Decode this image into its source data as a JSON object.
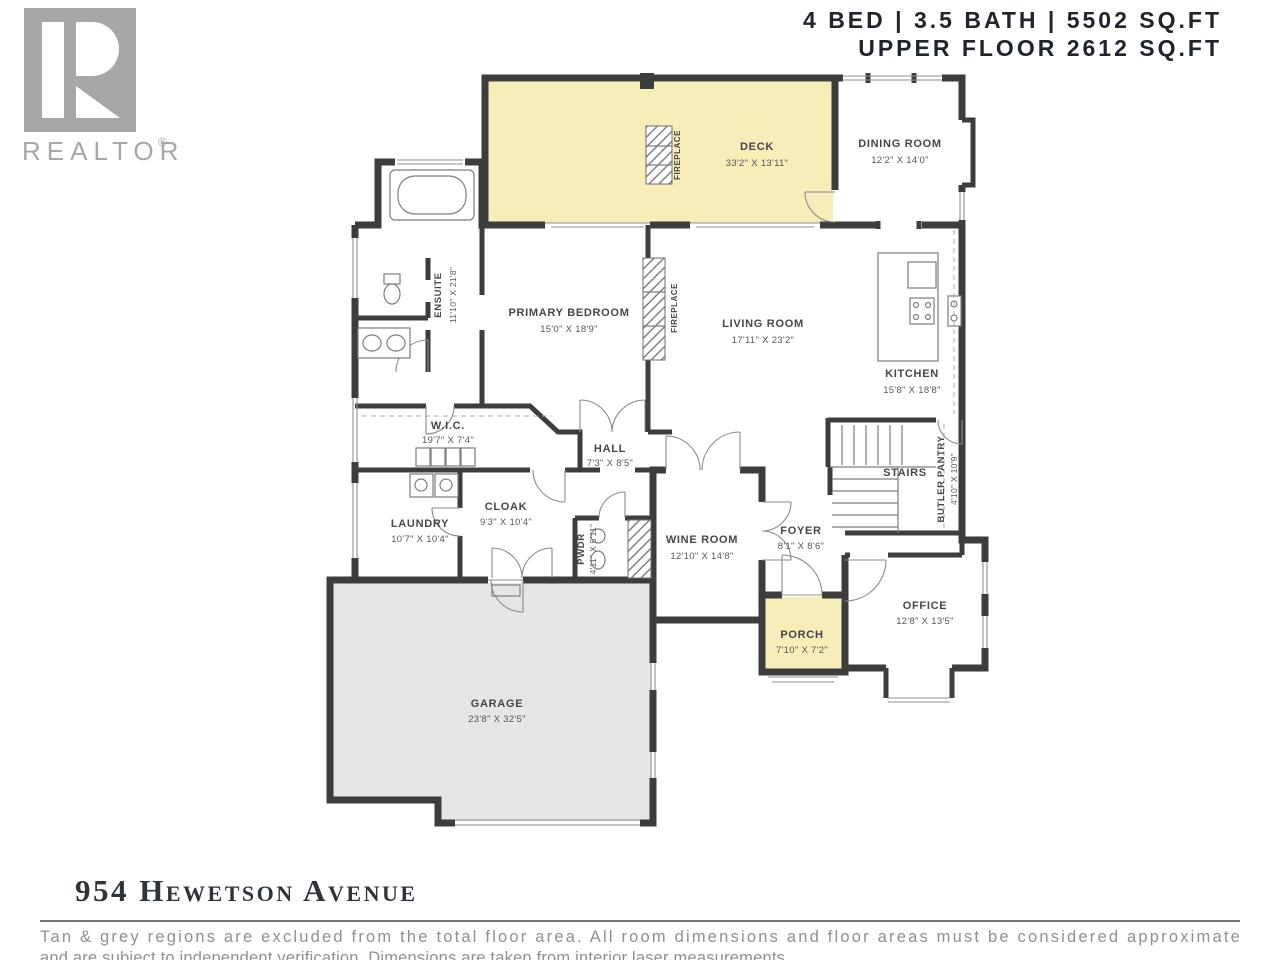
{
  "header": {
    "line1": "4 BED | 3.5 BATH | 5502 SQ.FT",
    "line2": "UPPER FLOOR 2612 SQ.FT"
  },
  "logo": {
    "brand": "REALTOR",
    "registered": "®"
  },
  "footer": {
    "title": "954 Hewetson Avenue",
    "disclaimer_line1": "Tan & grey regions are excluded from the total floor area. All room dimensions and floor areas must be considered approximate",
    "disclaimer_line2": "and are subject to independent verification. Dimensions are taken from interior laser measurements."
  },
  "colors": {
    "wall": "#3d3d3d",
    "excluded_tan": "#f6edb8",
    "excluded_grey": "#e4e5e6",
    "logo_grey": "#a7a7a7",
    "heading_text": "#20242c",
    "label_text": "#474747",
    "disclaimer_text": "#909090"
  },
  "rooms": {
    "deck": {
      "name": "DECK",
      "dims": "33'2\" X 13'11\""
    },
    "dining": {
      "name": "DINING ROOM",
      "dims": "12'2\" X 14'0\""
    },
    "ensuite": {
      "name": "ENSUITE",
      "dims": "11'10\" X 21'8\""
    },
    "primary": {
      "name": "PRIMARY BEDROOM",
      "dims": "15'0\" X 18'9\""
    },
    "living": {
      "name": "LIVING ROOM",
      "dims": "17'11\" X 23'2\""
    },
    "kitchen": {
      "name": "KITCHEN",
      "dims": "15'8\" X 18'8\""
    },
    "wic": {
      "name": "W.I.C.",
      "dims": "19'7\" X 7'4\""
    },
    "hall": {
      "name": "HALL",
      "dims": "7'3\" X 8'5\""
    },
    "stairs": {
      "name": "STAIRS"
    },
    "butler": {
      "name": "BUTLER PANTRY",
      "dims": "4'10\" X 10'9\""
    },
    "laundry": {
      "name": "LAUNDRY",
      "dims": "10'7\" X 10'4\""
    },
    "cloak": {
      "name": "CLOAK",
      "dims": "9'3\" X 10'4\""
    },
    "pwdr": {
      "name": "PWDR",
      "dims": "4'11\" X 5'11\""
    },
    "wine": {
      "name": "WINE ROOM",
      "dims": "12'10\" X 14'8\""
    },
    "foyer": {
      "name": "FOYER",
      "dims": "8'1\" X 8'6\""
    },
    "porch": {
      "name": "PORCH",
      "dims": "7'10\" X 7'2\""
    },
    "office": {
      "name": "OFFICE",
      "dims": "12'8\" X 13'5\""
    },
    "garage": {
      "name": "GARAGE",
      "dims": "23'8\" X 32'5\""
    },
    "fireplace": {
      "name": "FIREPLACE"
    }
  }
}
